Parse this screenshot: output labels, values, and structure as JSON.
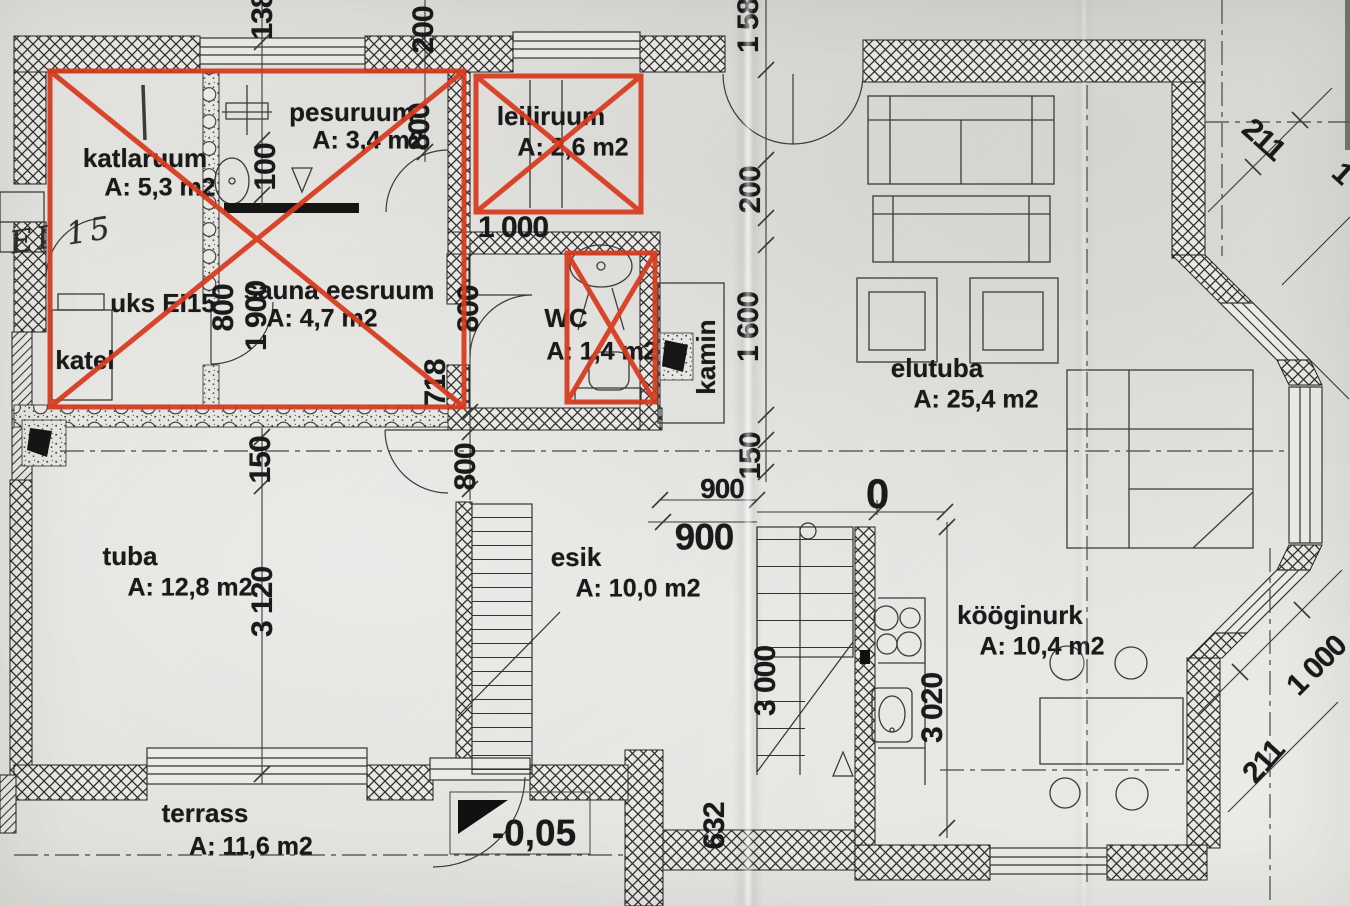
{
  "plan": {
    "title": "first-floor plan (scanned)",
    "rooms": [
      {
        "id": "katlaruum",
        "name": "katlaruum",
        "area": "A: 5,3 m2",
        "crossed_out": true
      },
      {
        "id": "pesuruum",
        "name": "pesuruum",
        "area": "A: 3,4 m2",
        "crossed_out": true
      },
      {
        "id": "leiliruum",
        "name": "leiliruum",
        "area": "A: 2,6 m2",
        "crossed_out": true
      },
      {
        "id": "sauna-eesruum",
        "name": "sauna eesruum",
        "area": "A: 4,7 m2",
        "crossed_out": true
      },
      {
        "id": "wc",
        "name": "WC",
        "area": "A: 1,4 m2",
        "crossed_out": true
      },
      {
        "id": "elutuba",
        "name": "elutuba",
        "area": "A: 25,4 m2",
        "crossed_out": false
      },
      {
        "id": "tuba",
        "name": "tuba",
        "area": "A: 12,8 m2",
        "crossed_out": false
      },
      {
        "id": "esik",
        "name": "esik",
        "area": "A: 10,0 m2",
        "crossed_out": false
      },
      {
        "id": "kooginurk",
        "name": "kööginurk",
        "area": "A: 10,4 m2",
        "crossed_out": false
      },
      {
        "id": "terrass",
        "name": "terrass",
        "area": "A: 11,6 m2",
        "crossed_out": false
      }
    ],
    "labels": {
      "door": "uks EI15",
      "boiler": "katel",
      "fireplace": "kamin",
      "handwritten": "EI 15",
      "level": "-0,05"
    },
    "dimensions": [
      "138",
      "200",
      "800",
      "100",
      "800",
      "1 900",
      "1 000",
      "800",
      "718",
      "800",
      "150",
      "3 120",
      "1 580",
      "200",
      "1 600",
      "150",
      "900",
      "900",
      "0",
      "3 000",
      "3 020",
      "632",
      "211",
      "1 000",
      "211",
      "1 000"
    ],
    "colors": {
      "paper": "#e1e0dc",
      "ink": "#1e1e1e",
      "red_overlay": "#d83a1d"
    }
  }
}
